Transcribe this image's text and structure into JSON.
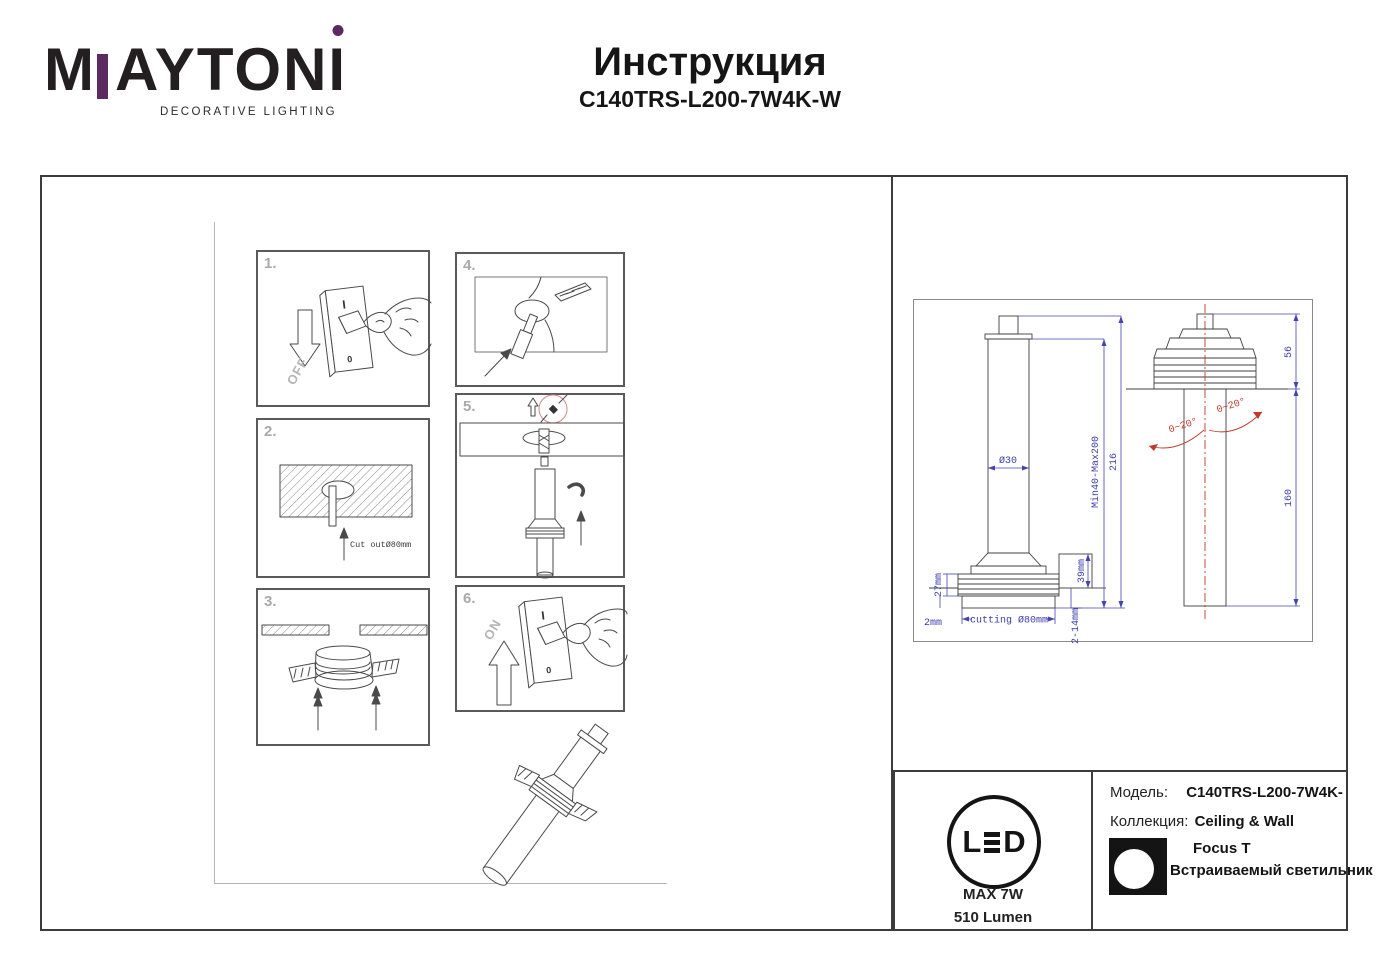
{
  "header": {
    "logo": {
      "part_m": "M",
      "part_rest": "AYTON",
      "part_last": "I",
      "tagline": "DECORATIVE LIGHTING"
    },
    "title": "Инструкция",
    "subtitle": "C140TRS-L200-7W4K-W"
  },
  "steps": {
    "s1": {
      "num": "1.",
      "arrow_label": "OFF",
      "sw_on": "I",
      "sw_off": "0"
    },
    "s2": {
      "num": "2.",
      "cut_label": "Cut outØ80mm"
    },
    "s3": {
      "num": "3."
    },
    "s4": {
      "num": "4."
    },
    "s5": {
      "num": "5."
    },
    "s6": {
      "num": "6.",
      "arrow_label": "ON",
      "sw_on": "I",
      "sw_off": "0"
    }
  },
  "tech": {
    "left": {
      "dia_tube": "Ø30",
      "height_range": "Min40-Max200",
      "height_total": "216",
      "d39": "39mm",
      "d27": "27mm",
      "d2": "2mm",
      "cutting": "cutting Ø80mm",
      "d2_14": "2-14mm"
    },
    "right": {
      "d56": "56",
      "d160": "160",
      "angle_left": "0~20°",
      "angle_right": "0~20°"
    }
  },
  "info": {
    "led_l": "L",
    "led_d": "D",
    "max_power": "MAX 7W",
    "lumen": "510 Lumen",
    "model_label": "Модель:",
    "model_value": "C140TRS-L200-7W4K-",
    "collection_label": "Коллекция:",
    "collection_value": "Ceiling & Wall",
    "series": "Focus T",
    "product_type": "Встраиваемый светильник"
  },
  "colors": {
    "brand_purple": "#5b2a60",
    "dimension_blue": "#4444b0",
    "accent_red": "#c0392b",
    "detail_circle_pink": "#d08a84"
  }
}
